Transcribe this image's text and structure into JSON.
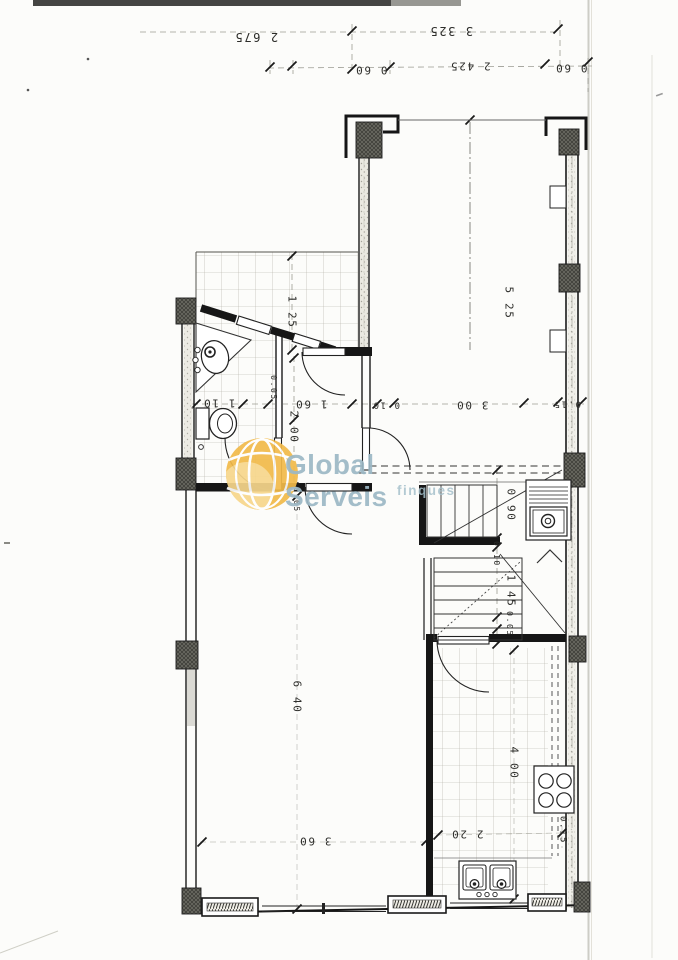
{
  "watermark": {
    "brand": "Global Serveis",
    "tagline": "finques",
    "text_color": "#9cb8c5",
    "globe_color": "#f2ba4a",
    "globe_highlight": "#f7d78c"
  },
  "fixtures": [
    "washbasin",
    "toilet",
    "staircase-upper-flight",
    "staircase-lower-flight",
    "kitchenette-sink",
    "stove-hob",
    "double-kitchen-sink",
    "structural-columns",
    "door-swings",
    "windows",
    "tiled-floor"
  ],
  "dimension_labels": [
    {
      "text": "2 675",
      "x": 256,
      "y": 37,
      "rot": 180,
      "s": 12
    },
    {
      "text": "3 325",
      "x": 451,
      "y": 31,
      "rot": 180,
      "s": 12
    },
    {
      "text": "0 60",
      "x": 371,
      "y": 70,
      "rot": 180,
      "s": 11
    },
    {
      "text": "2 425",
      "x": 470,
      "y": 66,
      "rot": 180,
      "s": 11
    },
    {
      "text": "0 60",
      "x": 571,
      "y": 68,
      "rot": 180,
      "s": 11
    },
    {
      "text": "1 25",
      "x": 292,
      "y": 312,
      "rot": 90,
      "s": 11
    },
    {
      "text": "5 25",
      "x": 509,
      "y": 303,
      "rot": 90,
      "s": 11
    },
    {
      "text": "0.05",
      "x": 273,
      "y": 388,
      "rot": 90,
      "s": 8
    },
    {
      "text": "1 10",
      "x": 219,
      "y": 403,
      "rot": 180,
      "s": 11
    },
    {
      "text": "1 60",
      "x": 311,
      "y": 404,
      "rot": 180,
      "s": 11
    },
    {
      "text": "2 00",
      "x": 294,
      "y": 427,
      "rot": 90,
      "s": 11
    },
    {
      "text": "0 10",
      "x": 386,
      "y": 404,
      "rot": 180,
      "s": 9
    },
    {
      "text": "3 00",
      "x": 472,
      "y": 405,
      "rot": 180,
      "s": 11
    },
    {
      "text": "0.15",
      "x": 567,
      "y": 403,
      "rot": 180,
      "s": 9
    },
    {
      "text": "0.05",
      "x": 296,
      "y": 500,
      "rot": 90,
      "s": 8
    },
    {
      "text": "0 90",
      "x": 511,
      "y": 505,
      "rot": 90,
      "s": 11
    },
    {
      "text": "0.10",
      "x": 496,
      "y": 554,
      "rot": 90,
      "s": 8
    },
    {
      "text": "1 45",
      "x": 511,
      "y": 591,
      "rot": 90,
      "s": 11
    },
    {
      "text": "0.05",
      "x": 509,
      "y": 624,
      "rot": 90,
      "s": 8
    },
    {
      "text": "6 40",
      "x": 297,
      "y": 697,
      "rot": 90,
      "s": 11
    },
    {
      "text": "4 00",
      "x": 514,
      "y": 763,
      "rot": 90,
      "s": 11
    },
    {
      "text": "3 60",
      "x": 315,
      "y": 841,
      "rot": 180,
      "s": 11
    },
    {
      "text": "2 20",
      "x": 467,
      "y": 834,
      "rot": 180,
      "s": 11
    },
    {
      "text": "0.15",
      "x": 562,
      "y": 830,
      "rot": 90,
      "s": 9
    }
  ]
}
